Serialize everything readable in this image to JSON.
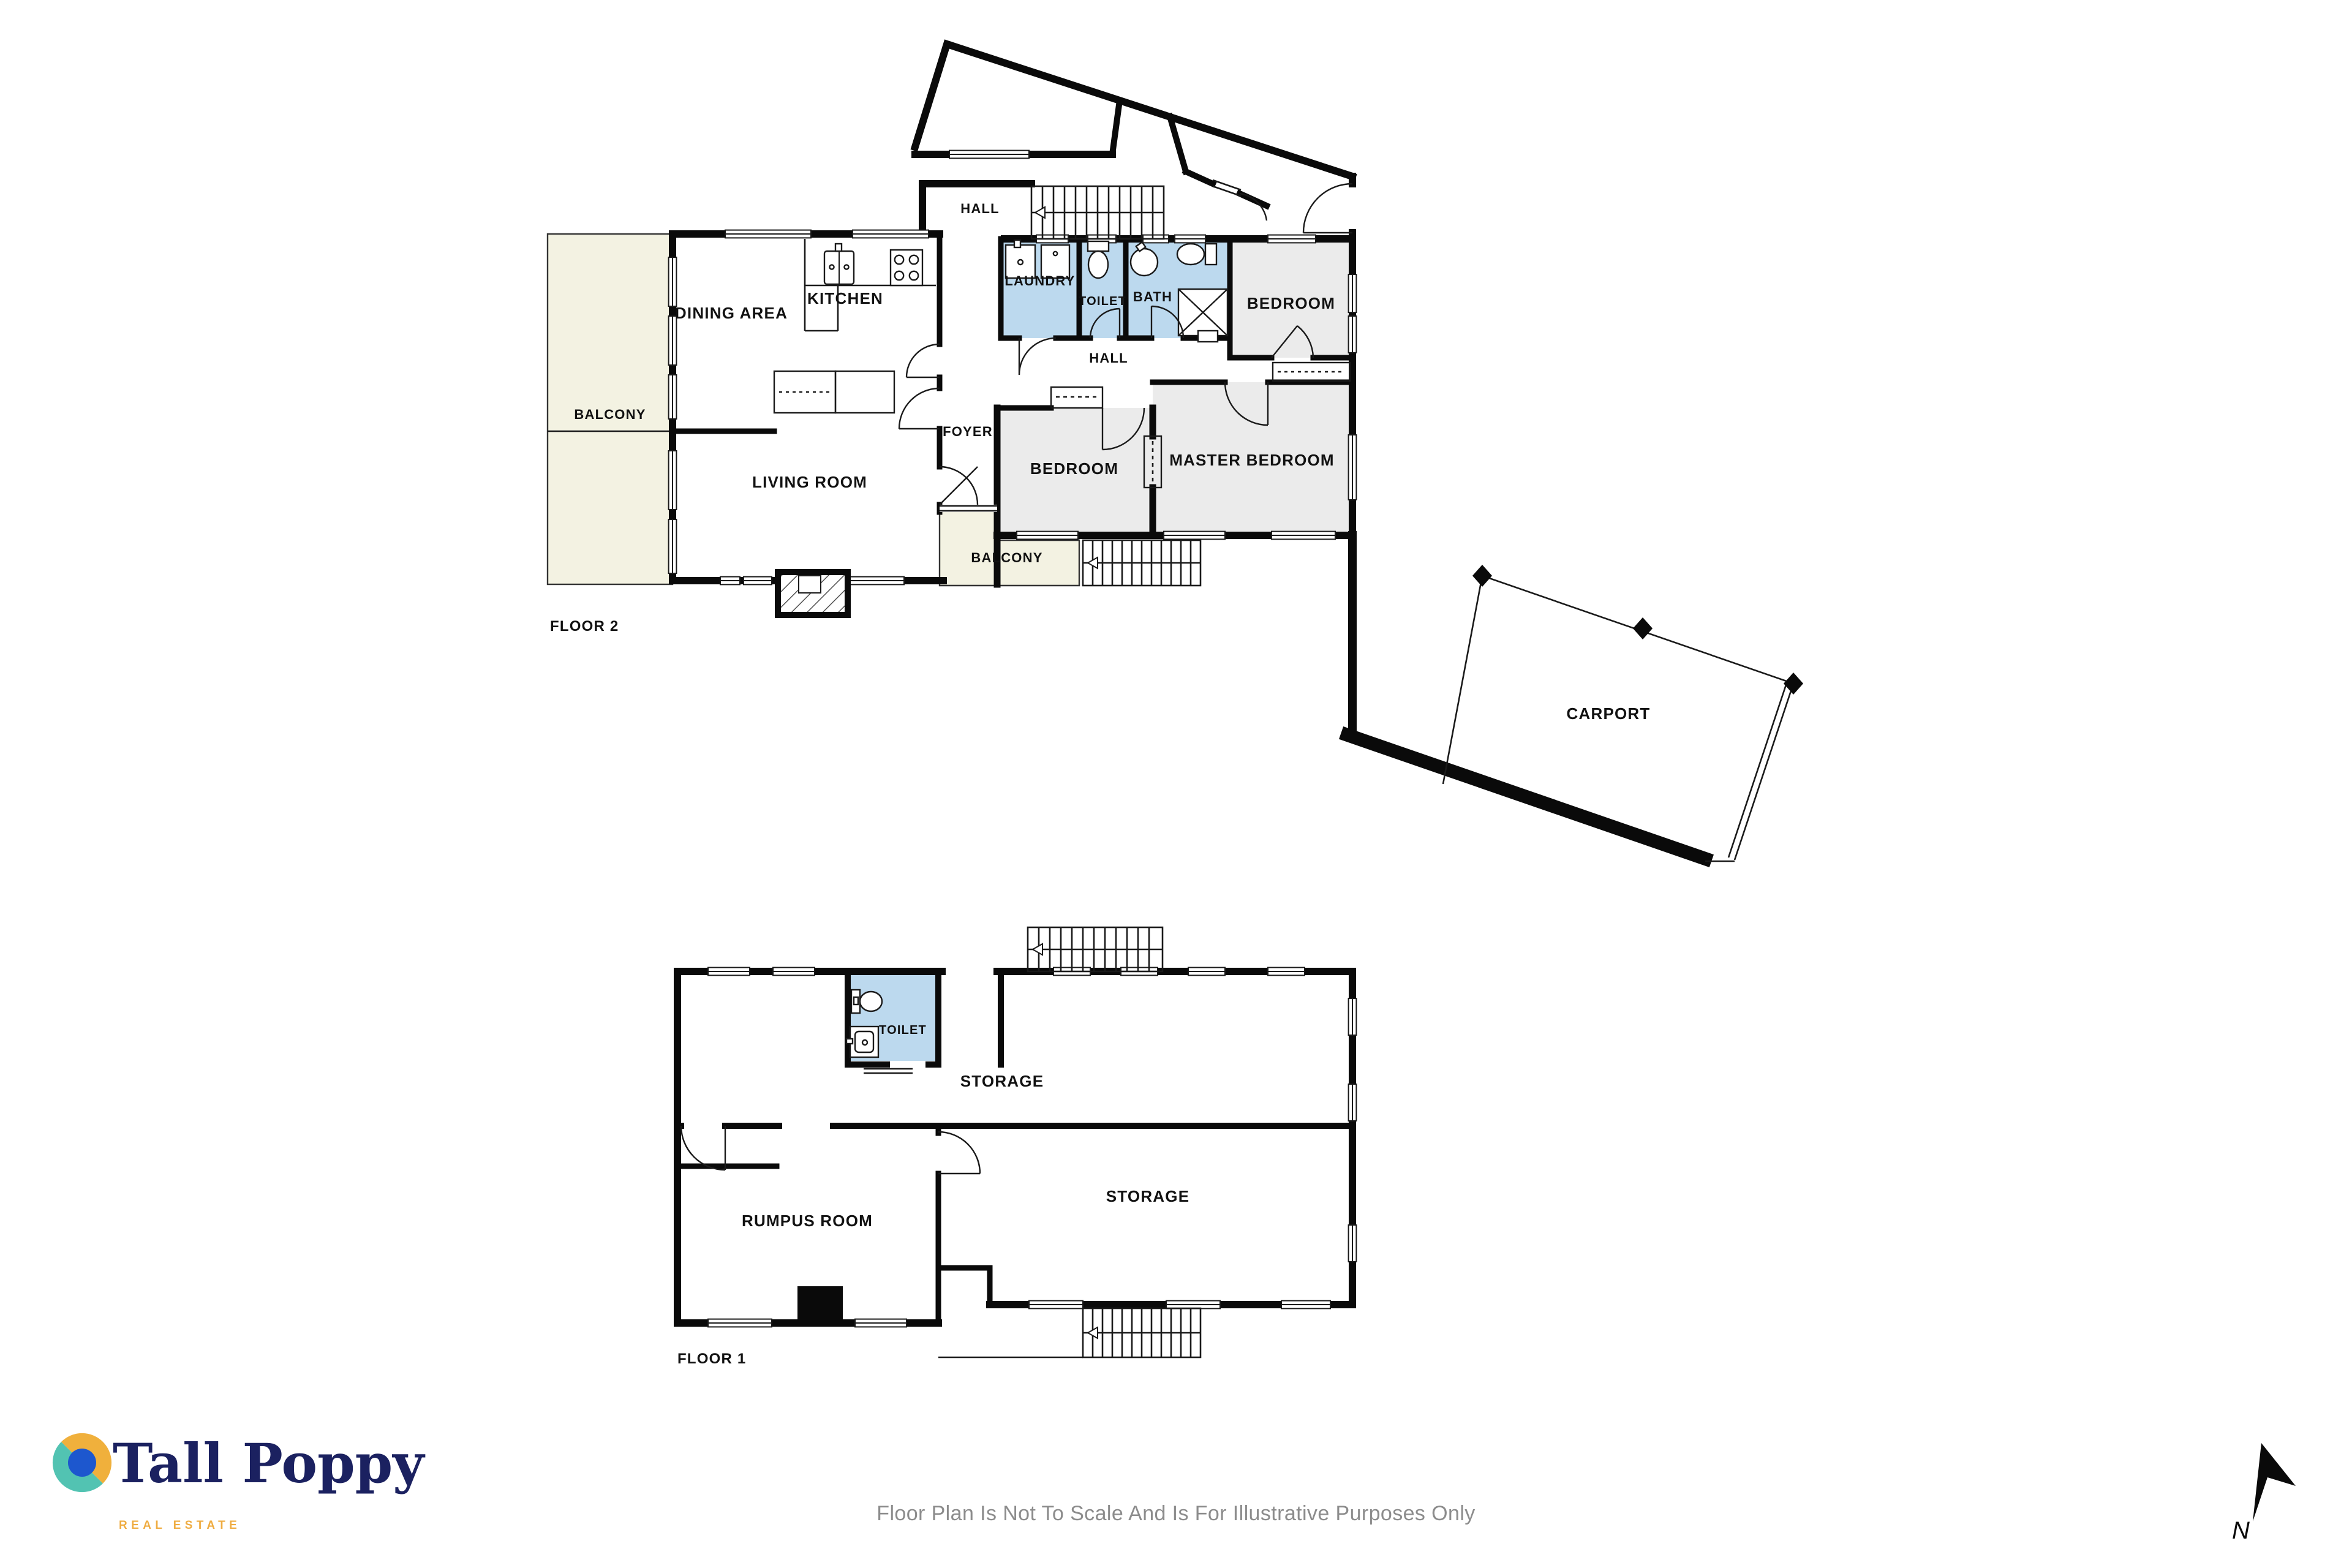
{
  "colors": {
    "wall": "#0a0a0a",
    "wet_room_fill": "#bcd9ee",
    "bedroom_fill": "#ebebeb",
    "balcony_fill": "#f3f2e2",
    "brand_navy": "#1b2160",
    "brand_gold": "#efac41",
    "brand_teal": "#52c3b2",
    "brand_blue": "#1d57ce",
    "disclaimer_gray": "#8c8c8c"
  },
  "floor2": {
    "title": "FLOOR 2",
    "rooms": {
      "balcony_left": "BALCONY",
      "dining": "DINING AREA",
      "kitchen": "KITCHEN",
      "hall_upper": "HALL",
      "laundry": "LAUNDRY",
      "toilet": "TOILET",
      "bath": "BATH",
      "bedroom": "BEDROOM",
      "hall": "HALL",
      "foyer": "FOYER",
      "living": "LIVING ROOM",
      "bedroom2": "BEDROOM",
      "master": "MASTER BEDROOM",
      "balcony_lower": "BALCONY",
      "carport": "CARPORT"
    }
  },
  "floor1": {
    "title": "FLOOR 1",
    "rooms": {
      "toilet": "TOILET",
      "storage_upper": "STORAGE",
      "rumpus": "RUMPUS ROOM",
      "storage_lower": "STORAGE"
    }
  },
  "footer": {
    "brand_name": "Tall Poppy",
    "brand_tagline": "REAL ESTATE",
    "disclaimer": "Floor Plan Is Not To Scale And Is For Illustrative Purposes Only",
    "north_label": "N"
  }
}
